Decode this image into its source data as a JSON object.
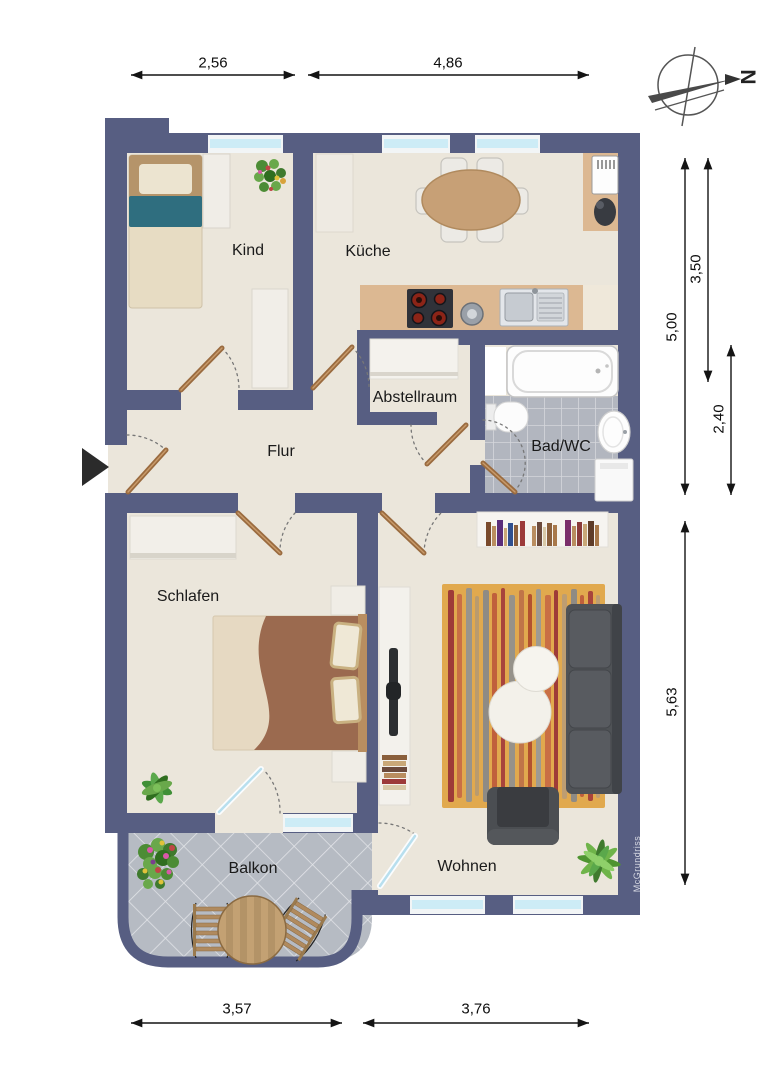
{
  "document": {
    "type": "apartment-floor-plan",
    "watermark": "McGrundriss"
  },
  "compass": {
    "label": "N"
  },
  "rooms": {
    "kind": {
      "label": "Kind"
    },
    "kueche": {
      "label": "Küche"
    },
    "abstellraum": {
      "label": "Abstellraum"
    },
    "flur": {
      "label": "Flur"
    },
    "bad_wc": {
      "label": "Bad/WC"
    },
    "schlafen": {
      "label": "Schlafen"
    },
    "wohnen": {
      "label": "Wohnen"
    },
    "balkon": {
      "label": "Balkon"
    }
  },
  "dimensions_m": {
    "top": [
      "2,56",
      "4,86"
    ],
    "right": [
      "5,00",
      "3,50",
      "2,40",
      "5,63"
    ],
    "bottom": [
      "3,57",
      "3,76"
    ]
  },
  "furniture": {
    "kind": [
      "single-bed",
      "cabinet",
      "plant",
      "tall-cabinet"
    ],
    "kueche": [
      "dining-table-with-chairs",
      "tall-cabinet",
      "fridge",
      "small-appliance",
      "countertop",
      "stove",
      "coffee-machine",
      "double-sink"
    ],
    "abstellraum": [
      "shelf"
    ],
    "bad_wc": [
      "bathtub",
      "toilet",
      "washbasin",
      "washing-machine"
    ],
    "schlafen": [
      "wardrobe",
      "double-bed",
      "nightstands",
      "plant",
      "balcony-glass-door"
    ],
    "wohnen": [
      "bookshelf",
      "tv-sideboard",
      "tv",
      "striped-rug",
      "sofa",
      "coffee-tables",
      "armchair",
      "plant",
      "balcony-glass-door"
    ],
    "balkon": [
      "flower-pot",
      "round-wood-table",
      "two-chairs"
    ]
  },
  "colors": {
    "wall": "#575e82",
    "floor": "#ebe6db",
    "counter": "#dcb892",
    "bath_tiles": "#b2b6bf",
    "balcony_tiles": "#b6bbc3",
    "window_glass": "#cdecf6",
    "door_wood": "#a3734a",
    "rug": "#e1a94e",
    "sofa": "#4f5256",
    "teal_blanket": "#2f6e7f",
    "bed_blanket": "#9b6a4f",
    "dimension_text": "#111111"
  }
}
